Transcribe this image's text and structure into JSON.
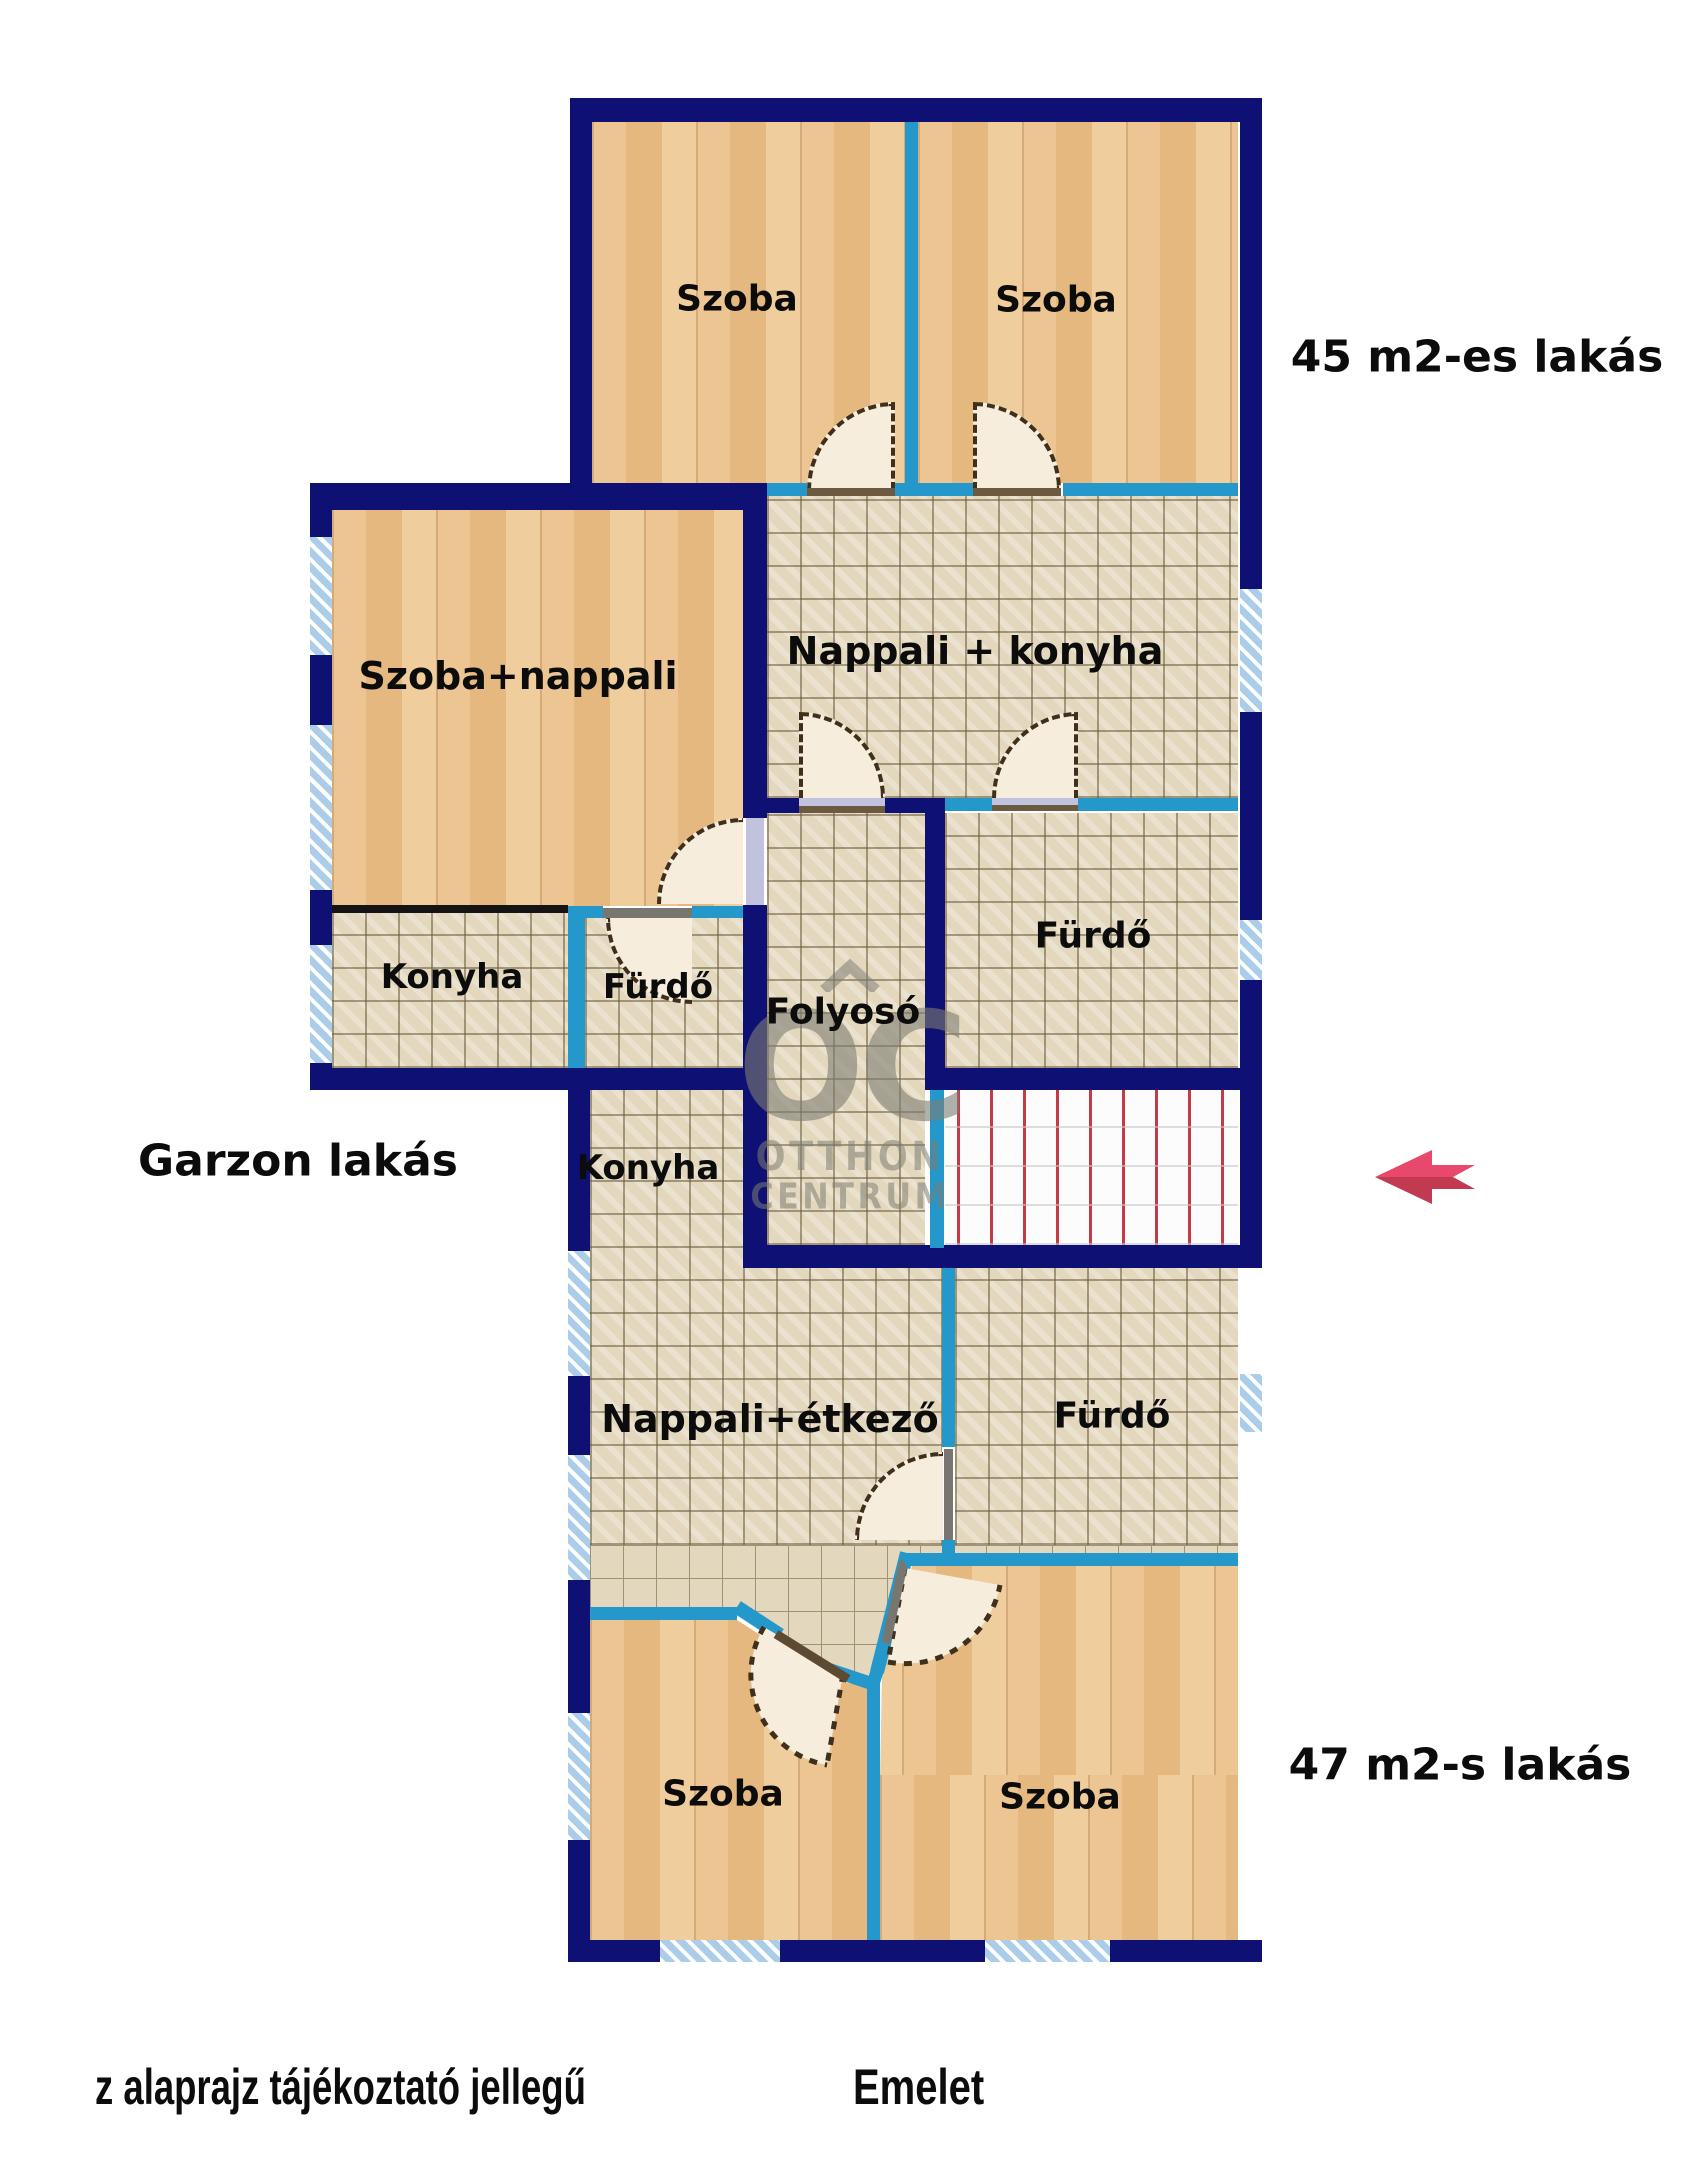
{
  "plan": {
    "apartment_labels": {
      "top": "45 m2-es lakás",
      "garzon": "Garzon lakás",
      "bottom": "47 m2-s lakás"
    },
    "rooms": {
      "szoba_45_left": "Szoba",
      "szoba_45_right": "Szoba",
      "nappali_konyha_45": "Nappali + konyha",
      "furdo_45": "Fürdő",
      "szoba_nappali_garzon": "Szoba+nappali",
      "konyha_garzon": "Konyha",
      "furdo_garzon": "Fürdő",
      "folyoso": "Folyosó",
      "konyha_47": "Konyha",
      "nappali_etkezo_47": "Nappali+étkező",
      "furdo_47": "Fürdő",
      "szoba_47_left": "Szoba",
      "szoba_47_right": "Szoba"
    },
    "watermark": {
      "logo": "OC",
      "line1": "OTTHON",
      "line2": "CENTRUM"
    },
    "footer": {
      "disclaimer": "z alaprajz tájékoztató jellegű",
      "floor_label": "Emelet"
    },
    "colors": {
      "wall_navy": "#0e1173",
      "wall_cyan": "#2598cb",
      "wood_floor": "#eac28e",
      "tile_floor": "#e3d7bd",
      "window_blue": "#abcde9",
      "stairs_red": "#c23b47",
      "door_cream": "#f6eddc",
      "arrow_pink": "#e8486b",
      "arrow_dark": "#c23a52",
      "watermark_gray": "#7d7d73"
    }
  }
}
